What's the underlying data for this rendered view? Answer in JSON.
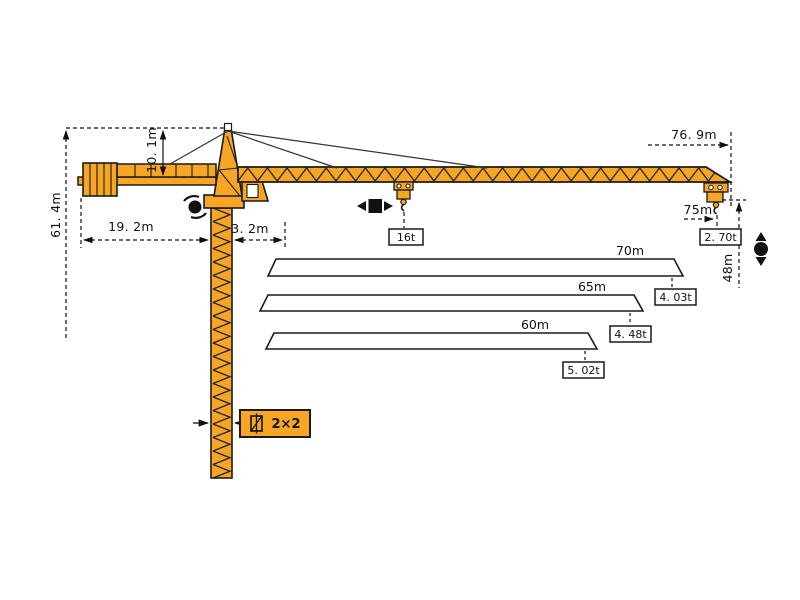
{
  "title": "tower-crane-dimension-diagram",
  "colors": {
    "crane_orange": "#F6A623",
    "outline_black": "#1a1a1a",
    "background": "#ffffff"
  },
  "dims": {
    "tower_height": "61. 4m",
    "head_height": "10. 1m",
    "counterjib_length": "19. 2m",
    "mast_offset": "3. 2m",
    "max_radius": "76. 9m",
    "tip_radius": "75m",
    "hook_height": "48m",
    "mast_section": "2×2"
  },
  "loads": {
    "max_capacity": "16t",
    "tip_capacity": "2. 70t"
  },
  "bars": [
    {
      "length": "70m",
      "capacity": "4. 03t"
    },
    {
      "length": "65m",
      "capacity": "4. 48t"
    },
    {
      "length": "60m",
      "capacity": "5. 02t"
    }
  ]
}
